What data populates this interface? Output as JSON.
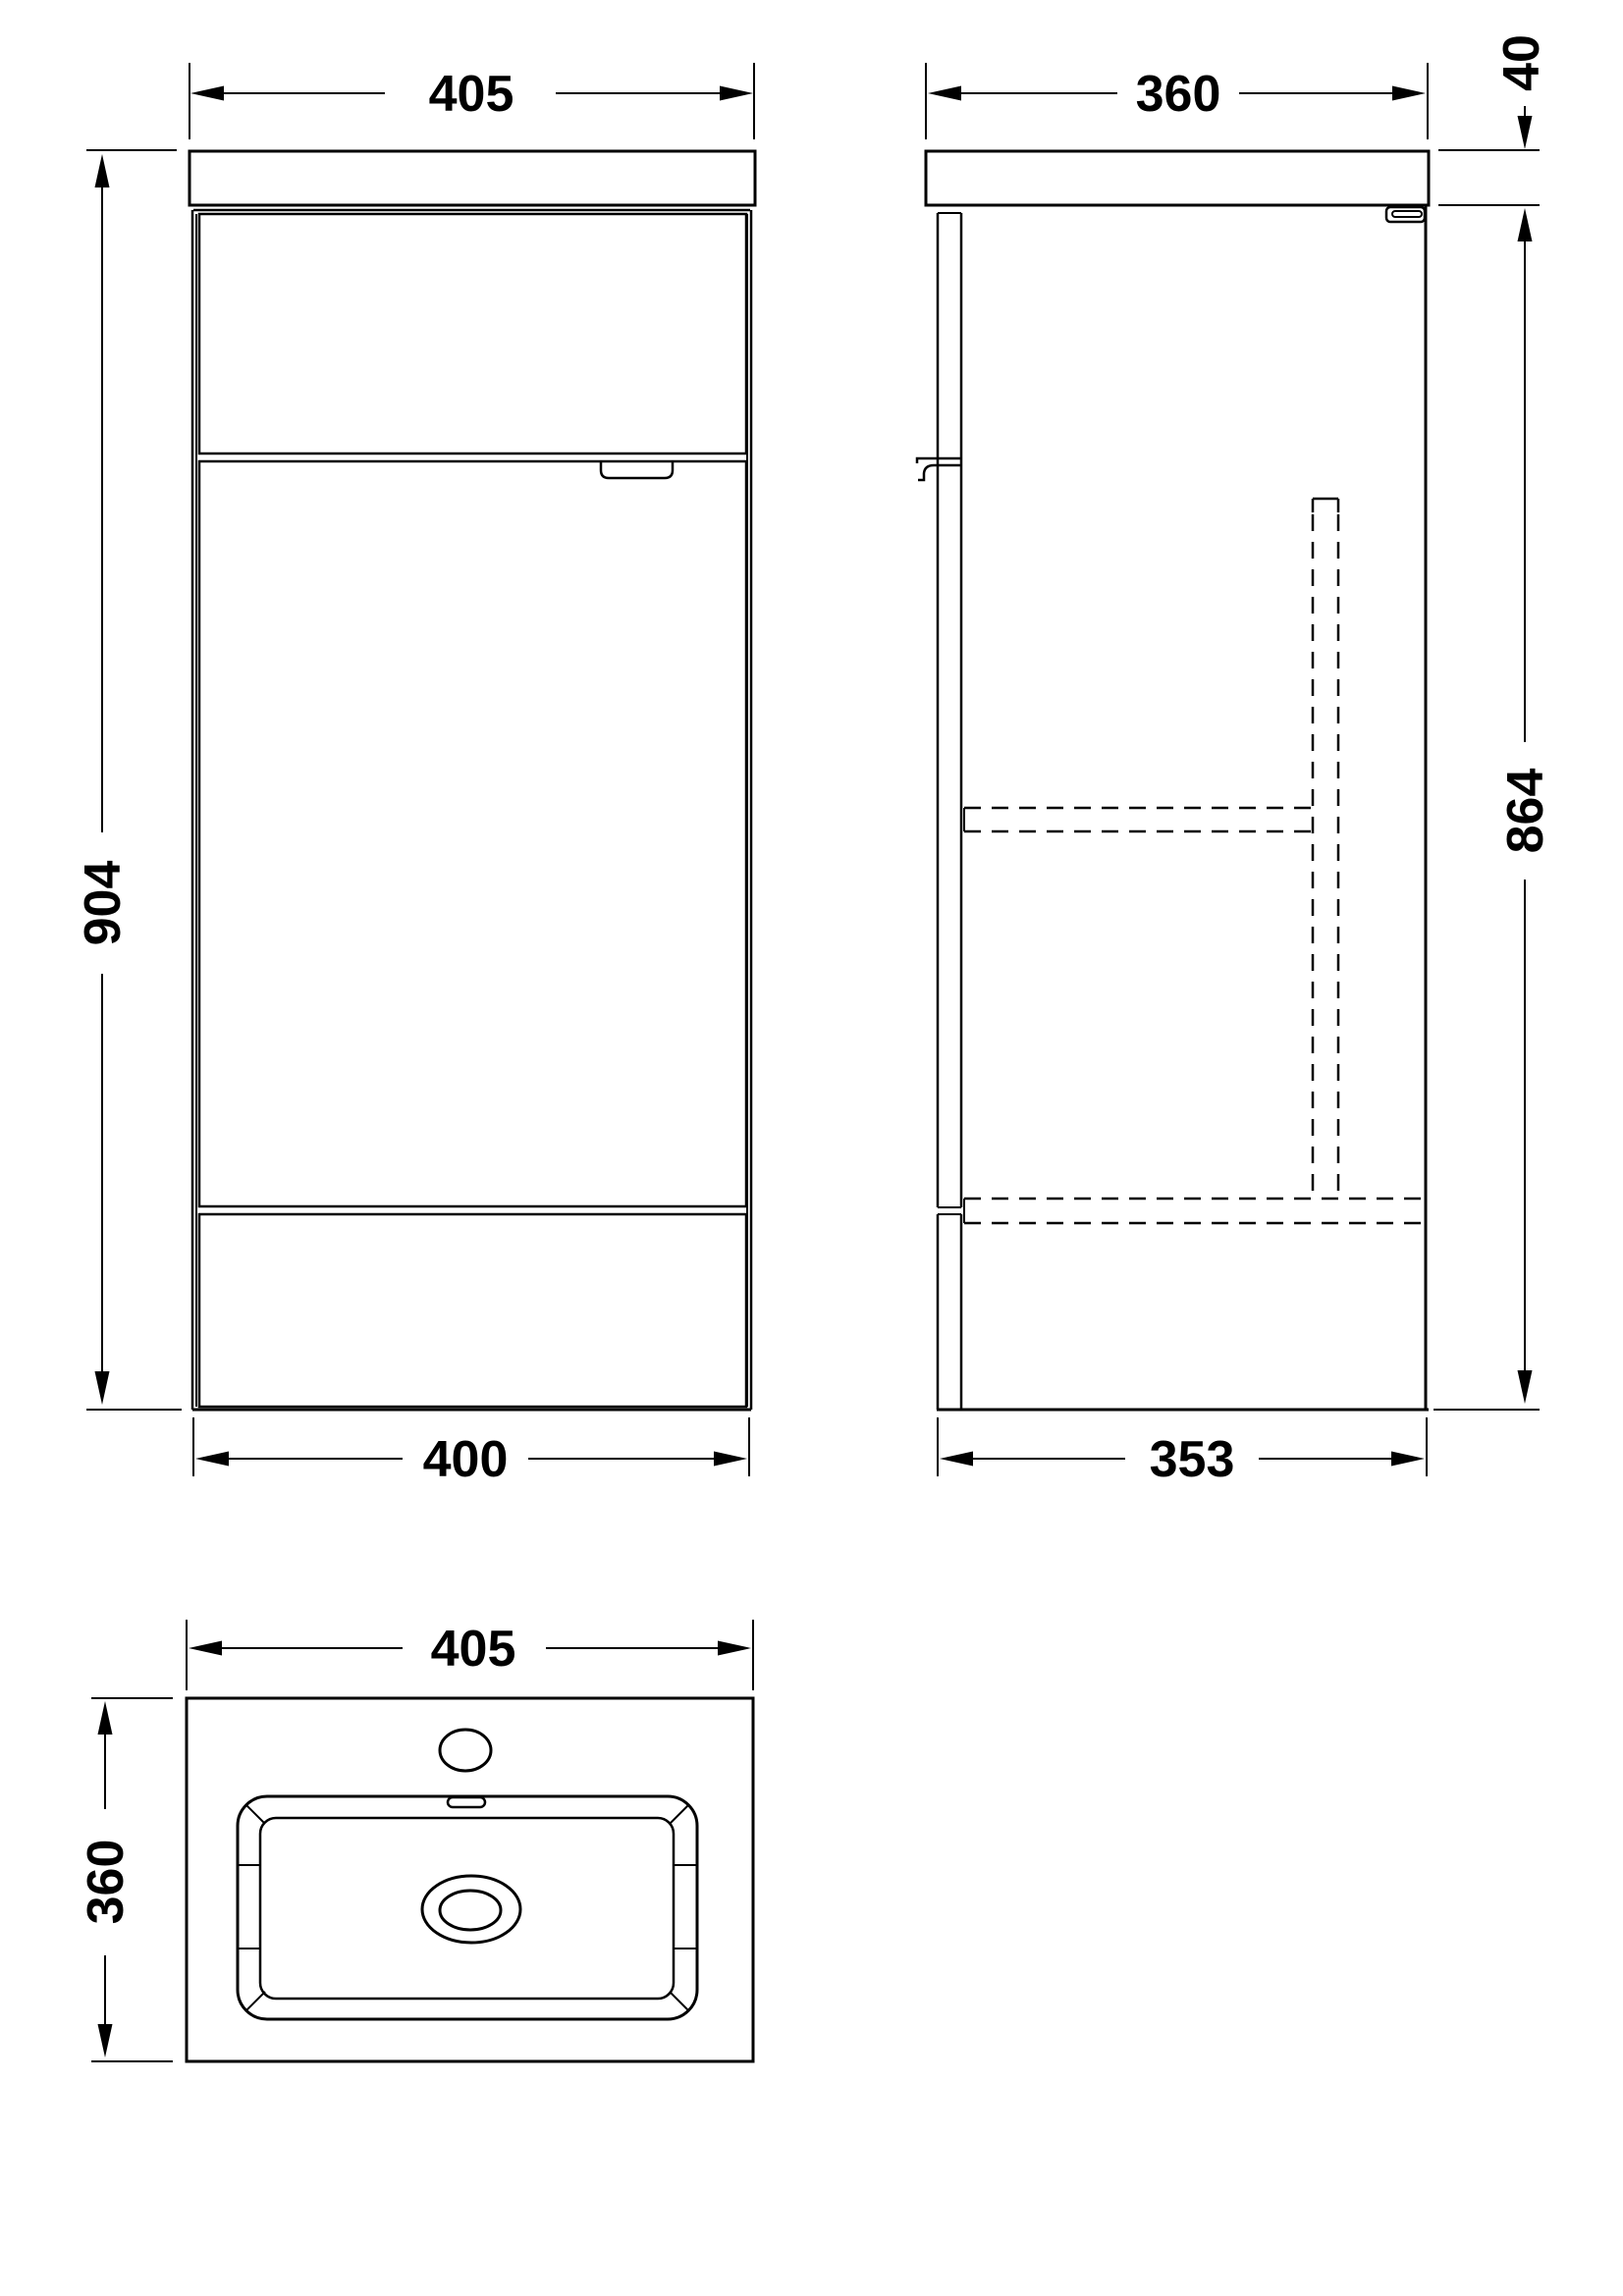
{
  "drawing": {
    "background_color": "#ffffff",
    "line_color": "#000000",
    "views": {
      "front": {
        "label": "front-elevation",
        "width_label": "405",
        "height_label": "904",
        "base_width_label": "400"
      },
      "side": {
        "label": "side-elevation",
        "depth_label": "360",
        "top_thickness_label": "40",
        "body_height_label": "864",
        "base_depth_label": "353"
      },
      "plan": {
        "label": "basin-plan",
        "width_label": "405",
        "depth_label": "360"
      }
    }
  }
}
